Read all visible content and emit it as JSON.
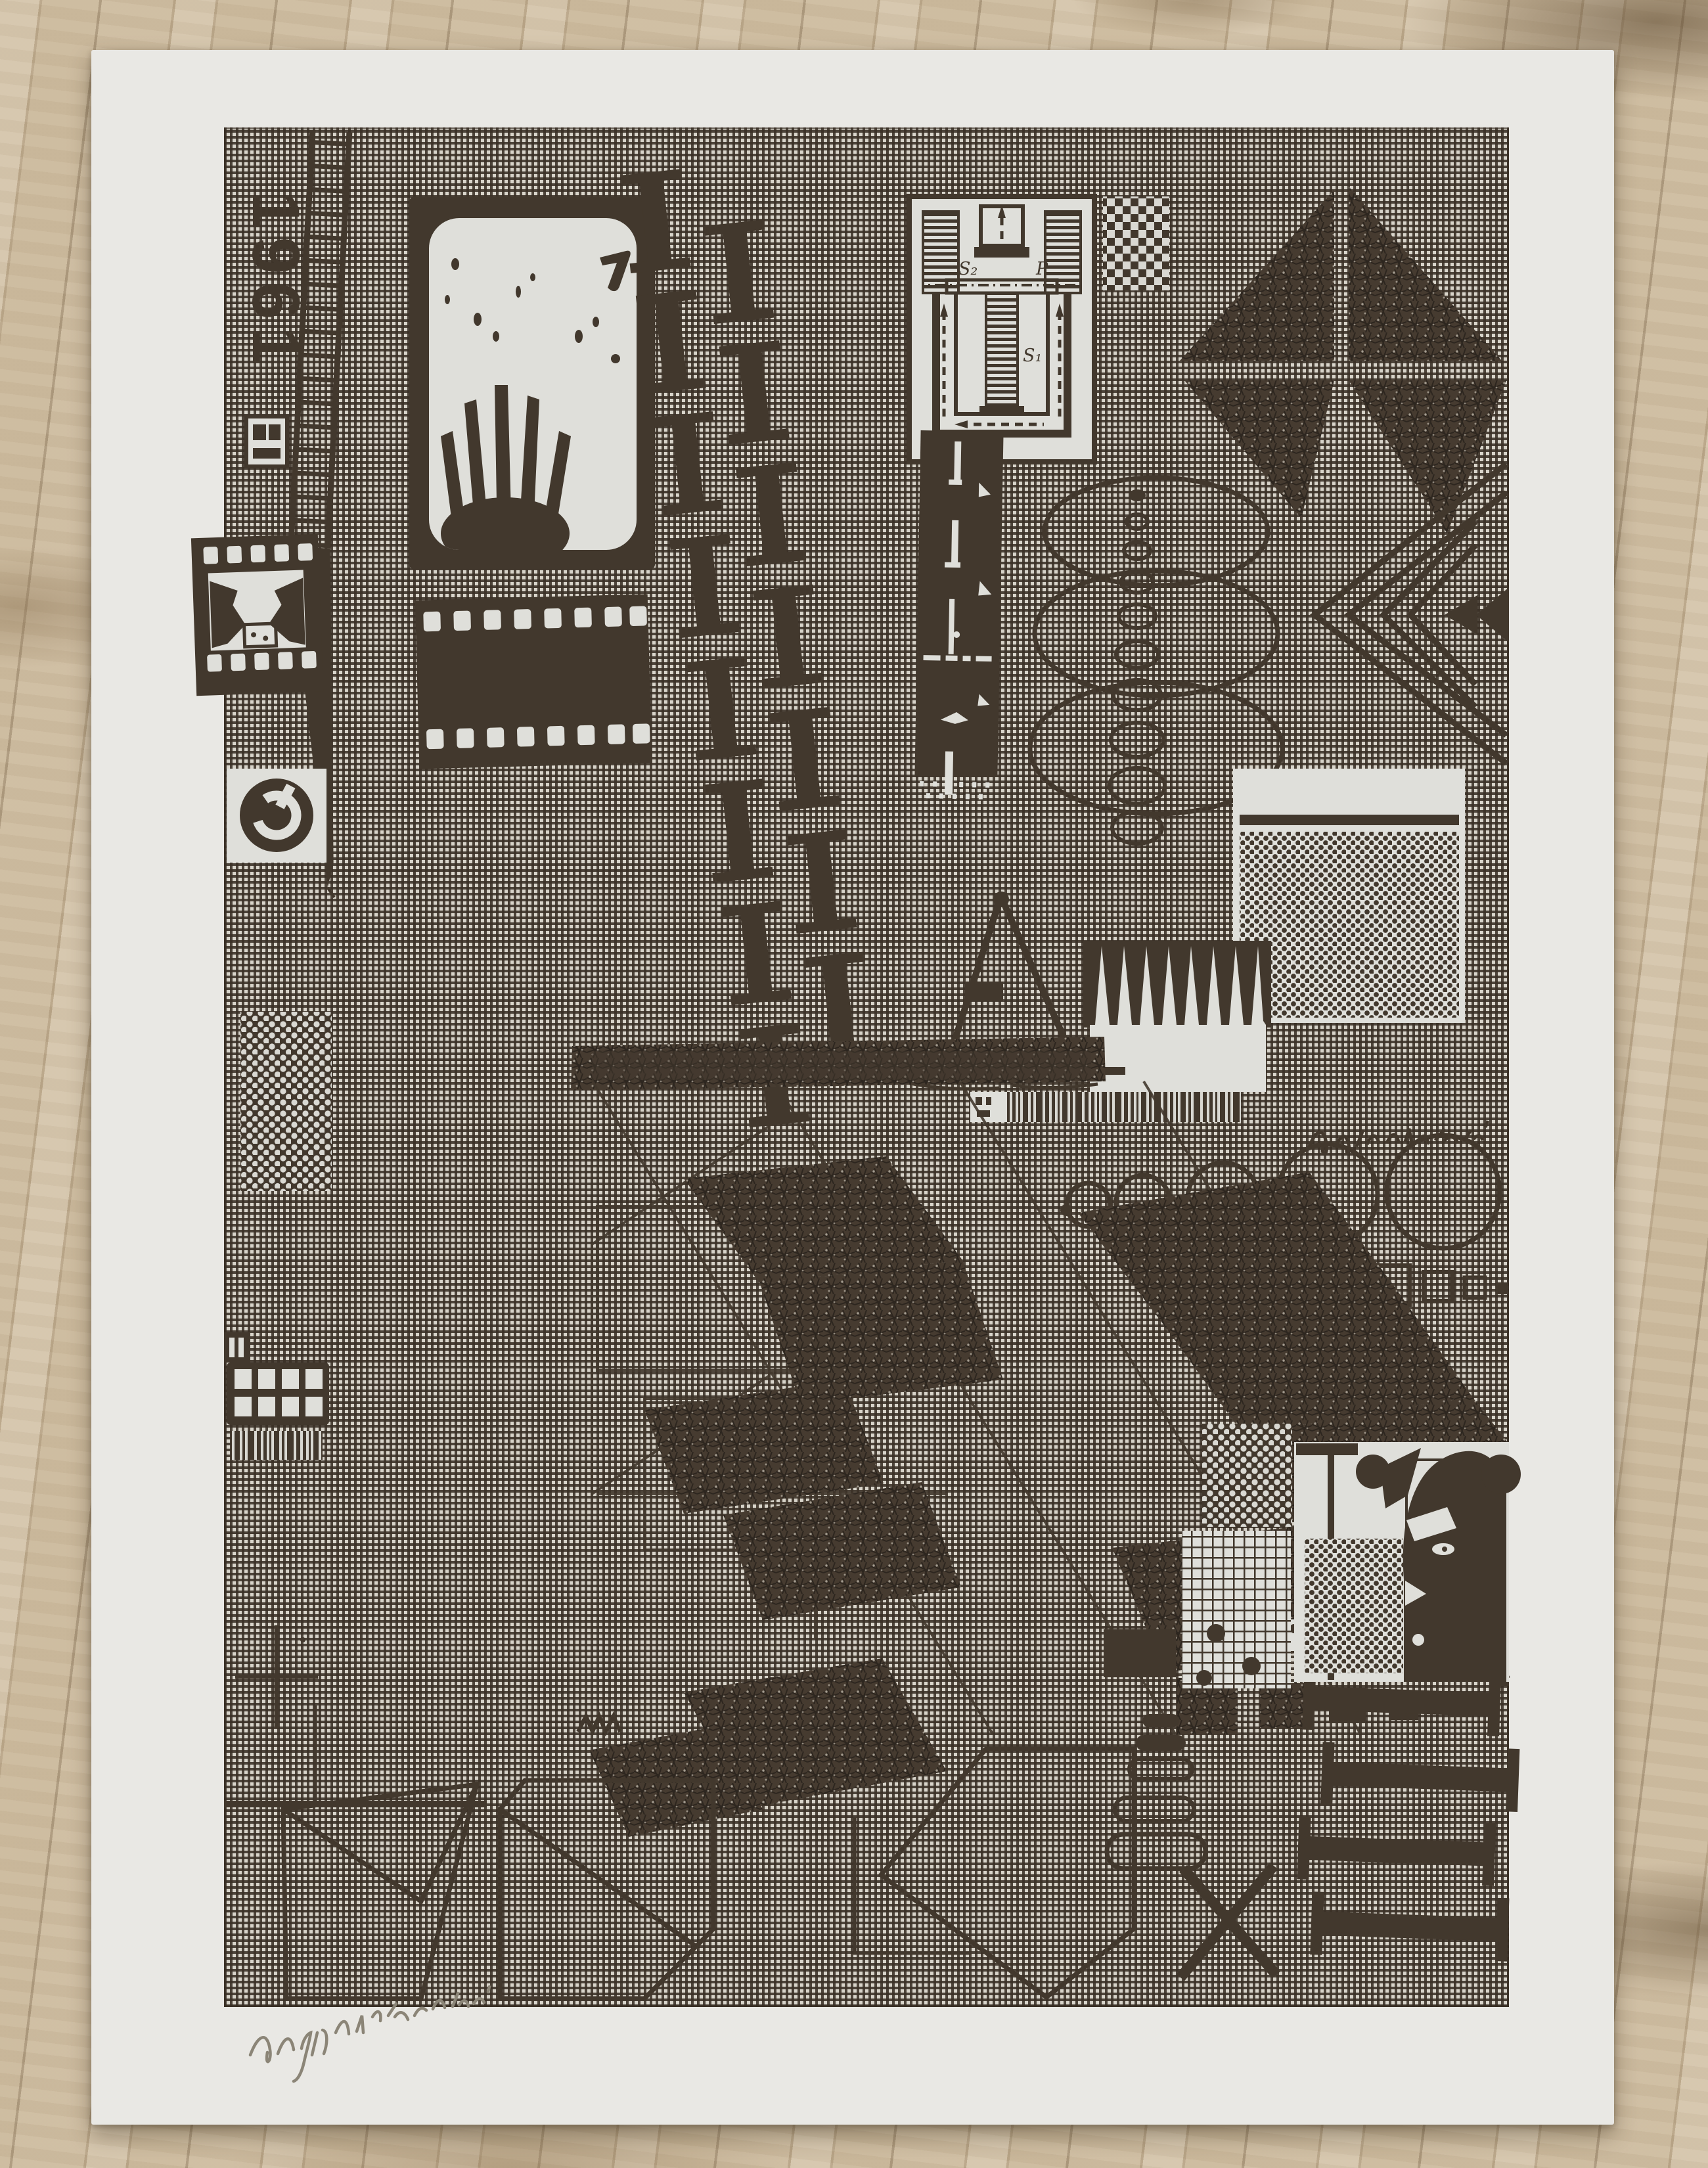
{
  "colors": {
    "floor": "#c6b498",
    "paper": "#e9e8e4",
    "ink": "#42382d",
    "white": "#dfdfda",
    "pencil": "#8b8577"
  },
  "artwork": {
    "year_text": "1961",
    "diagram_labels": {
      "s2": "S₂",
      "p": "P",
      "s1": "S₁"
    }
  }
}
